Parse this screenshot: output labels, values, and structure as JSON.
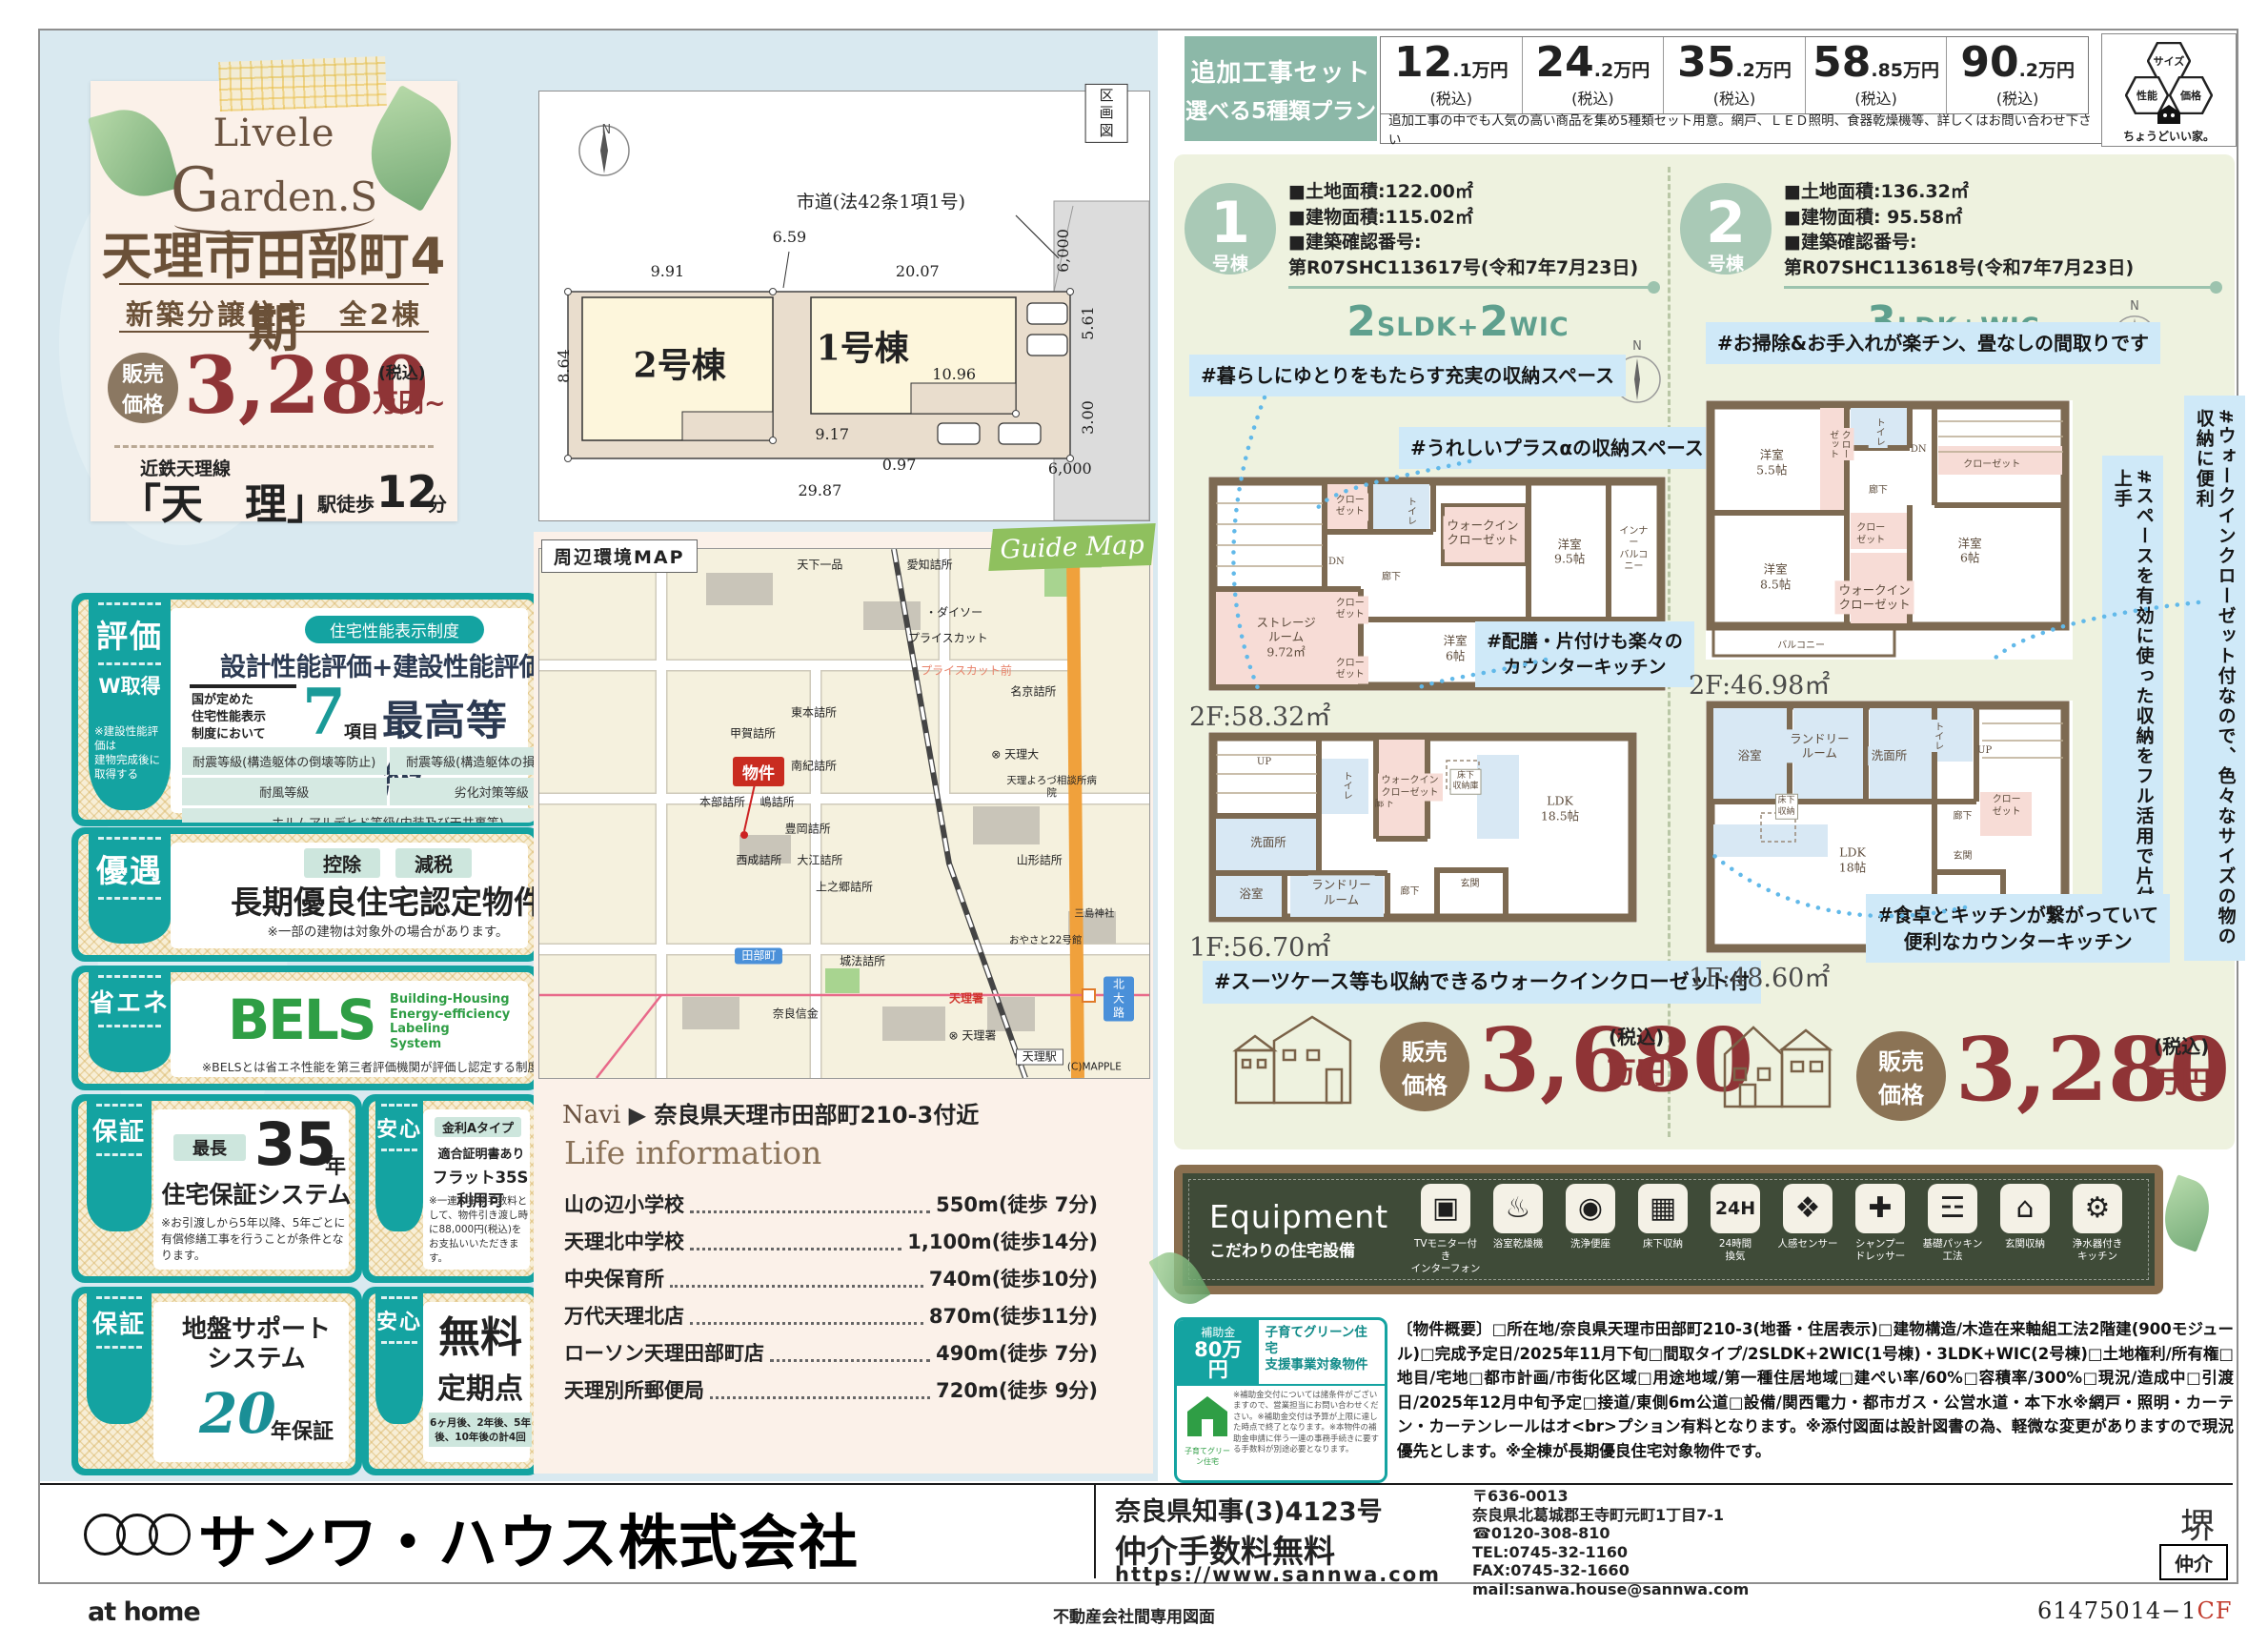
{
  "hero": {
    "logo1": "Livele",
    "logo_g": "G",
    "logo2": "arden.S",
    "title": "天理市田部町4期",
    "subtitle": "新築分譲住宅　全2棟",
    "price_label": "販売\n価格",
    "price_value": "3,280",
    "price_tax": "(税込)",
    "price_unit": "万円~",
    "line_name": "近鉄天理線",
    "station": "「天　理」",
    "walk_prefix": "駅徒歩",
    "walk_min": "12",
    "walk_suffix": "分"
  },
  "plot": {
    "labels": [
      {
        "t": "N",
        "x": 11,
        "y": 9,
        "c": "n"
      },
      {
        "t": "区画図",
        "x": 93,
        "y": 5,
        "c": "tag"
      },
      {
        "t": "市道(法42条1項1号)",
        "x": 56,
        "y": 26,
        "c": "road"
      },
      {
        "t": "9.91",
        "x": 21,
        "y": 42
      },
      {
        "t": "6.59",
        "x": 41,
        "y": 34
      },
      {
        "t": "20.07",
        "x": 62,
        "y": 42
      },
      {
        "t": "8.64",
        "x": 4,
        "y": 64,
        "c": "rot"
      },
      {
        "t": "5.61",
        "x": 90,
        "y": 54,
        "c": "rot"
      },
      {
        "t": "10.96",
        "x": 68,
        "y": 66
      },
      {
        "t": "9.17",
        "x": 48,
        "y": 80
      },
      {
        "t": "0.97",
        "x": 59,
        "y": 87
      },
      {
        "t": "29.87",
        "x": 46,
        "y": 93
      },
      {
        "t": "3.00",
        "x": 90,
        "y": 76,
        "c": "rot"
      },
      {
        "t": "6,000",
        "x": 86,
        "y": 37,
        "c": "rot"
      },
      {
        "t": "6,000",
        "x": 87,
        "y": 88
      },
      {
        "t": "2号棟",
        "x": 23,
        "y": 64,
        "c": "unit"
      },
      {
        "t": "1号棟",
        "x": 53,
        "y": 60,
        "c": "unit"
      }
    ]
  },
  "rating": {
    "tab": "評価",
    "tab2": "W取得",
    "tab_note": "※建設性能評価は\n建物完成後に\n取得する",
    "pill": "住宅性能表示制度",
    "headline": "設計性能評価+建設性能評価",
    "pre": "国が定めた\n住宅性能表示\n制度において",
    "num": "7",
    "num_unit": "項目",
    "grade": "最高等級",
    "cells": [
      {
        "t": "耐震等級(構造躯体の倒壊等防止)"
      },
      {
        "t": "耐震等級(構造躯体の損傷防止)"
      },
      {
        "t": "耐風等級"
      },
      {
        "t": "劣化対策等級"
      },
      {
        "t": "ホルムアルデヒド等級(内装及び天井裏等)",
        "w": 2
      },
      {
        "t": "維持管理対策等級"
      },
      {
        "t": "一次エネルギー消費量等級"
      }
    ]
  },
  "yugu": {
    "tab": "優遇",
    "pills": [
      "控除",
      "減税"
    ],
    "headline": "長期優良住宅認定物件",
    "note": "※一部の建物は対象外の場合があります。"
  },
  "shoene": {
    "tab": "省エネ",
    "bels": "BELS",
    "bels_sub": "Building-Housing\nEnergy-efficiency\nLabeling\nSystem",
    "note": "※BELSとは省エネ性能を第三者評価機関が評価し認定する制度です。"
  },
  "hosho35": {
    "tab": "保証",
    "pill": "最長",
    "num": "35",
    "unit": "年",
    "headline": "住宅保証システム",
    "note": "※お引渡しから5年以降、5年ごとに有償修繕工事を行うことが条件となります。"
  },
  "anshin_flat": {
    "tab": "安心",
    "line1": "金利Aタイプ",
    "line2": "適合証明書あり",
    "headline": "フラット35S利用可",
    "note": "※一連の事務手数料として、物件引き渡し時に88,000円(税込)をお支払いいただきます。"
  },
  "hosho20": {
    "tab": "保証",
    "headline": "地盤サポート\nシステム",
    "num": "20",
    "unit": "年保証"
  },
  "anshin_tenken": {
    "tab": "安心",
    "headline1": "無料",
    "headline2": "定期点検",
    "note": "6ヶ月後、2年後、5年後、10年後の計4回"
  },
  "map": {
    "tab": "周辺環境MAP",
    "ribbon": "Guide Map",
    "marker": "物件",
    "labels": [
      {
        "t": "天下一品",
        "x": 46,
        "y": 3
      },
      {
        "t": "愛知詰所",
        "x": 64,
        "y": 3
      },
      {
        "t": "山の辺小学校",
        "x": 86,
        "y": 2,
        "c": "green"
      },
      {
        "t": "・ダイソー",
        "x": 68,
        "y": 12
      },
      {
        "t": "プライスカット",
        "x": 67,
        "y": 17
      },
      {
        "t": "プライスカット前",
        "x": 70,
        "y": 23,
        "c": "salmon"
      },
      {
        "t": "名京詰所",
        "x": 81,
        "y": 27
      },
      {
        "t": "東本詰所",
        "x": 45,
        "y": 31
      },
      {
        "t": "甲賀詰所",
        "x": 35,
        "y": 35
      },
      {
        "t": "南紀詰所",
        "x": 45,
        "y": 41
      },
      {
        "t": "⊗ 天理大",
        "x": 78,
        "y": 39
      },
      {
        "t": "天理よろづ相談所病院",
        "x": 84,
        "y": 45,
        "c": "tiny"
      },
      {
        "t": "本部詰所",
        "x": 30,
        "y": 48
      },
      {
        "t": "嶋詰所",
        "x": 39,
        "y": 48
      },
      {
        "t": "豊岡詰所",
        "x": 44,
        "y": 53
      },
      {
        "t": "西成詰所",
        "x": 36,
        "y": 59
      },
      {
        "t": "大江詰所",
        "x": 46,
        "y": 59
      },
      {
        "t": "上之郷詰所",
        "x": 50,
        "y": 64
      },
      {
        "t": "山形詰所",
        "x": 82,
        "y": 59
      },
      {
        "t": "三島神社",
        "x": 91,
        "y": 69,
        "c": "tiny"
      },
      {
        "t": "田部町",
        "x": 36,
        "y": 77,
        "c": "chip"
      },
      {
        "t": "城法詰所",
        "x": 53,
        "y": 78
      },
      {
        "t": "おやさと22号館",
        "x": 83,
        "y": 74,
        "c": "tiny"
      },
      {
        "t": "奈良信金",
        "x": 42,
        "y": 88
      },
      {
        "t": "天理署",
        "x": 70,
        "y": 85,
        "c": "red"
      },
      {
        "t": "⊗ 天理署",
        "x": 71,
        "y": 92
      },
      {
        "t": "北大路",
        "x": 95,
        "y": 85,
        "c": "chip"
      },
      {
        "t": "天理駅",
        "x": 82,
        "y": 96,
        "c": "chipw"
      },
      {
        "t": "(C)MAPPLE",
        "x": 91,
        "y": 98,
        "c": "tiny"
      }
    ]
  },
  "navi": {
    "prefix": "Navi",
    "arrow": "▶",
    "address": "奈良県天理市田部町210-3付近"
  },
  "life": {
    "title": "Life information",
    "items": [
      {
        "n": "山の辺小学校",
        "v": "550m(徒歩 7分)"
      },
      {
        "n": "天理北中学校",
        "v": "1,100m(徒歩14分)"
      },
      {
        "n": "中央保育所",
        "v": "740m(徒歩10分)"
      },
      {
        "n": "万代天理北店",
        "v": "870m(徒歩11分)"
      },
      {
        "n": "ローソン天理田部町店",
        "v": "490m(徒歩 7分)"
      },
      {
        "n": "天理別所郵便局",
        "v": "720m(徒歩 9分)"
      }
    ]
  },
  "header": {
    "box1": "追加工事セット",
    "box2": "選べる5種類プラン",
    "prices": [
      {
        "i": "12",
        "d": ".1万円"
      },
      {
        "i": "24",
        "d": ".2万円"
      },
      {
        "i": "35",
        "d": ".2万円"
      },
      {
        "i": "58",
        "d": ".85万円"
      },
      {
        "i": "90",
        "d": ".2万円"
      }
    ],
    "tax": "(税込)",
    "note": "追加工事の中でも人気の高い商品を集め5種類セット用意。網戸、ＬＥＤ照明、食器乾燥機等、詳しくはお問い合わせ下さい",
    "hex": [
      "サイズ",
      "性能",
      "価格"
    ],
    "tagline": "ちょうどいい家。"
  },
  "b1": {
    "badge_num": "1",
    "badge_suffix": "号棟",
    "specs": [
      "■土地面積:122.00㎡",
      "■建物面積:115.02㎡",
      "■建築確認番号:",
      "第R07SHC113617号(令和7年7月23日)"
    ],
    "layout": [
      {
        "t": "2",
        "c": "b"
      },
      {
        "t": "SLDK",
        "c": "s"
      },
      {
        "t": "+",
        "c": "s"
      },
      {
        "t": "2",
        "c": "b"
      },
      {
        "t": "WIC",
        "c": "s"
      }
    ],
    "north": "N",
    "annotations": [
      "#暮らしにゆとりをもたらす充実の収納スペース",
      "#うれしいプラスαの収納スペース",
      "#配膳・片付けも楽々の\nカウンターキッチン",
      "#スーツケース等も収納できるウォークインクローゼット付"
    ],
    "floor2_label": "2F:58.32㎡",
    "floor1_label": "1F:56.70㎡",
    "floor2_rooms": [
      {
        "t": "クロー\nゼット",
        "x": 31,
        "y": 14,
        "c": "pink tiny"
      },
      {
        "t": "トイレ",
        "x": 44,
        "y": 16,
        "c": "blue v tiny"
      },
      {
        "t": "DN",
        "x": 28,
        "y": 40,
        "c": "tiny"
      },
      {
        "t": "廊下",
        "x": 40,
        "y": 47,
        "c": "tiny"
      },
      {
        "t": "ウォークイン\nクローゼット",
        "x": 60,
        "y": 26,
        "c": "pink"
      },
      {
        "t": "洋室\n9.5帖",
        "x": 79,
        "y": 35
      },
      {
        "t": "インナー\nバルコニー",
        "x": 93,
        "y": 34,
        "c": "tiny"
      },
      {
        "t": "ストレージ\nルーム\n9.72㎡",
        "x": 17,
        "y": 75,
        "c": "pink"
      },
      {
        "t": "クロー\nゼット",
        "x": 31,
        "y": 62,
        "c": "pink tiny"
      },
      {
        "t": "クロー\nゼット",
        "x": 31,
        "y": 90,
        "c": "pink tiny"
      },
      {
        "t": "洋室\n6帖",
        "x": 54,
        "y": 80
      }
    ],
    "floor1_rooms": [
      {
        "t": "UP",
        "x": 13,
        "y": 16,
        "c": "tiny"
      },
      {
        "t": "トイレ",
        "x": 32,
        "y": 28,
        "c": "blue v tiny"
      },
      {
        "t": "廊下",
        "x": 41,
        "y": 38,
        "c": "tiny"
      },
      {
        "t": "ウォークイン\nクローゼット",
        "x": 47,
        "y": 29,
        "c": "pink tiny"
      },
      {
        "t": "床下\n収納庫",
        "x": 60,
        "y": 26,
        "c": "box"
      },
      {
        "t": "LDK\n18.5帖",
        "x": 82,
        "y": 40
      },
      {
        "t": "洗面所",
        "x": 14,
        "y": 58,
        "c": "blue"
      },
      {
        "t": "浴室",
        "x": 10,
        "y": 85,
        "c": "blue"
      },
      {
        "t": "ランドリー\nルーム",
        "x": 31,
        "y": 84,
        "c": "blue"
      },
      {
        "t": "廊下",
        "x": 47,
        "y": 84,
        "c": "tiny"
      },
      {
        "t": "玄関",
        "x": 61,
        "y": 80,
        "c": "tiny"
      }
    ],
    "price": {
      "label": "販売\n価格",
      "value": "3,680",
      "tax": "(税込)",
      "unit": "万円"
    }
  },
  "b2": {
    "badge_num": "2",
    "badge_suffix": "号棟",
    "specs": [
      "■土地面積:136.32㎡",
      "■建物面積:  95.58㎡",
      "■建築確認番号:",
      "第R07SHC113618号(令和7年7月23日)"
    ],
    "layout": [
      {
        "t": "3",
        "c": "b"
      },
      {
        "t": "LDK",
        "c": "s"
      },
      {
        "t": "+",
        "c": "s"
      },
      {
        "t": "WIC",
        "c": "s"
      }
    ],
    "north": "N",
    "annotations": [
      "#お掃除&お手入れが楽チン、畳なしの間取りです",
      "#ウォークインクローゼット付なので、色々なサイズの物の収納に便利",
      "#スペースを有効に使った収納をフル活用で片付け上手",
      "#食卓とキッチンが繋がっていて\n便利なカウンターキッチン"
    ],
    "floor2_label": "2F:46.98㎡",
    "floor1_label": "1F:48.60㎡",
    "floor2_rooms": [
      {
        "t": "洋室\n5.5帖",
        "x": 18,
        "y": 24
      },
      {
        "t": "クロー\nゼット",
        "x": 36,
        "y": 17,
        "c": "pink tiny v"
      },
      {
        "t": "トイレ",
        "x": 47,
        "y": 12,
        "c": "blue v tiny"
      },
      {
        "t": "DN",
        "x": 58,
        "y": 19,
        "c": "tiny"
      },
      {
        "t": "クローゼット",
        "x": 78,
        "y": 25,
        "c": "pink tiny"
      },
      {
        "t": "廊下",
        "x": 47,
        "y": 35,
        "c": "tiny"
      },
      {
        "t": "クロー\nゼット",
        "x": 45,
        "y": 52,
        "c": "pink tiny"
      },
      {
        "t": "洋室\n6帖",
        "x": 72,
        "y": 58
      },
      {
        "t": "ウォークイン\nクローゼット",
        "x": 46,
        "y": 76,
        "c": "pink"
      },
      {
        "t": "洋室\n8.5帖",
        "x": 19,
        "y": 68
      },
      {
        "t": "バルコニー",
        "x": 26,
        "y": 95,
        "c": "tiny"
      }
    ],
    "floor1_rooms": [
      {
        "t": "浴室",
        "x": 12,
        "y": 22,
        "c": "blue"
      },
      {
        "t": "ランドリー\nルーム",
        "x": 31,
        "y": 18,
        "c": "blue"
      },
      {
        "t": "洗面所",
        "x": 50,
        "y": 22,
        "c": "blue"
      },
      {
        "t": "トイレ",
        "x": 63,
        "y": 14,
        "c": "blue v tiny"
      },
      {
        "t": "UP",
        "x": 76,
        "y": 20,
        "c": "tiny"
      },
      {
        "t": "クロー\nゼット",
        "x": 82,
        "y": 42,
        "c": "pink tiny"
      },
      {
        "t": "廊下",
        "x": 70,
        "y": 46,
        "c": "tiny"
      },
      {
        "t": "床下\n収納",
        "x": 22,
        "y": 42,
        "c": "box"
      },
      {
        "t": "LDK\n18帖",
        "x": 40,
        "y": 63
      },
      {
        "t": "玄関",
        "x": 70,
        "y": 62,
        "c": "tiny"
      }
    ],
    "price": {
      "label": "販売\n価格",
      "value": "3,280",
      "tax": "(税込)",
      "unit": "万円"
    }
  },
  "equipment": {
    "title": "Equipment",
    "subtitle": "こだわりの住宅設備",
    "items": [
      {
        "icon": "▣",
        "c": "",
        "label": "TVモニター付き\nインターフォン",
        "name": "tv-monitor-interphone-icon"
      },
      {
        "icon": "♨",
        "c": "",
        "label": "浴室乾燥機",
        "name": "bathroom-dryer-icon"
      },
      {
        "icon": "◉",
        "c": "",
        "label": "洗浄便座",
        "name": "washlet-icon"
      },
      {
        "icon": "▦",
        "c": "",
        "label": "床下収納",
        "name": "underfloor-storage-icon"
      },
      {
        "icon": "24H",
        "c": "txt",
        "label": "24時間\n換気",
        "name": "ventilation-24h-icon"
      },
      {
        "icon": "❖",
        "c": "",
        "label": "人感センサー",
        "name": "motion-sensor-icon"
      },
      {
        "icon": "✚",
        "c": "",
        "label": "シャンプー\nドレッサー",
        "name": "shampoo-dresser-icon"
      },
      {
        "icon": "☲",
        "c": "",
        "label": "基礎パッキン\n工法",
        "name": "foundation-packing-icon"
      },
      {
        "icon": "⌂",
        "c": "",
        "label": "玄関収納",
        "name": "entrance-storage-icon"
      },
      {
        "icon": "⚙",
        "c": "",
        "label": "浄水器付き\nキッチン",
        "name": "water-purifier-kitchen-icon"
      }
    ]
  },
  "subsidy": {
    "label": "補助金",
    "amount": "80万円",
    "title": "子育てグリーン住宅\n支援事業対象物件",
    "house_caption": "子育てグリーン住宅",
    "note": "※補助金交付については諸条件がございますので、営業担当にお問い合わせください。※補助金交付は予算が上限に達した時点で終了となります。※本物件の補助金申請に伴う一連の事務手続きに要する手数料が別途必要となります。"
  },
  "overview": "〔物件概要〕□所在地/奈良県天理市田部町210-3(地番・住居表示)□建物構造/木造在来軸組工法2階建(900モジュール)□完成予定日/2025年11月下旬□間取タイプ/2SLDK+2WIC(1号棟)・3LDK+WIC(2号棟)□土地権利/所有権□地目/宅地□都市計画/市街化区域□用途地域/第一種住居地域□建ぺい率/60%□容積率/300%□現況/造成中□引渡日/2025年12月中旬予定□接道/東側6m公道□設備/関西電力・都市ガス・公営水道・本下水※網戸・照明・カーテン・カーテンレールはオ<br>プション有料となります。※添付図面は設計図書の為、軽微な変更がありますので現況優先とします。※全棟が長期優良住宅対象物件です。",
  "company": {
    "name": "サンワ・ハウス株式会社",
    "license": "奈良県知事(3)4123号",
    "fee": "仲介手数料無料",
    "url": "https://www.sannwa.com",
    "addr": "〒636-0013\n奈良県北葛城郡王寺町元町1丁目7-1\n☎0120-308-810\nTEL:0745-32-1160\nFAX:0745-32-1660\nmail:sanwa.house@sannwa.com",
    "stamp": "堺",
    "broker": "仲介"
  },
  "footer": {
    "athome": "at home",
    "center": "不動産会社間専用図面",
    "code": "61475014−1",
    "code_suffix": "CF"
  }
}
